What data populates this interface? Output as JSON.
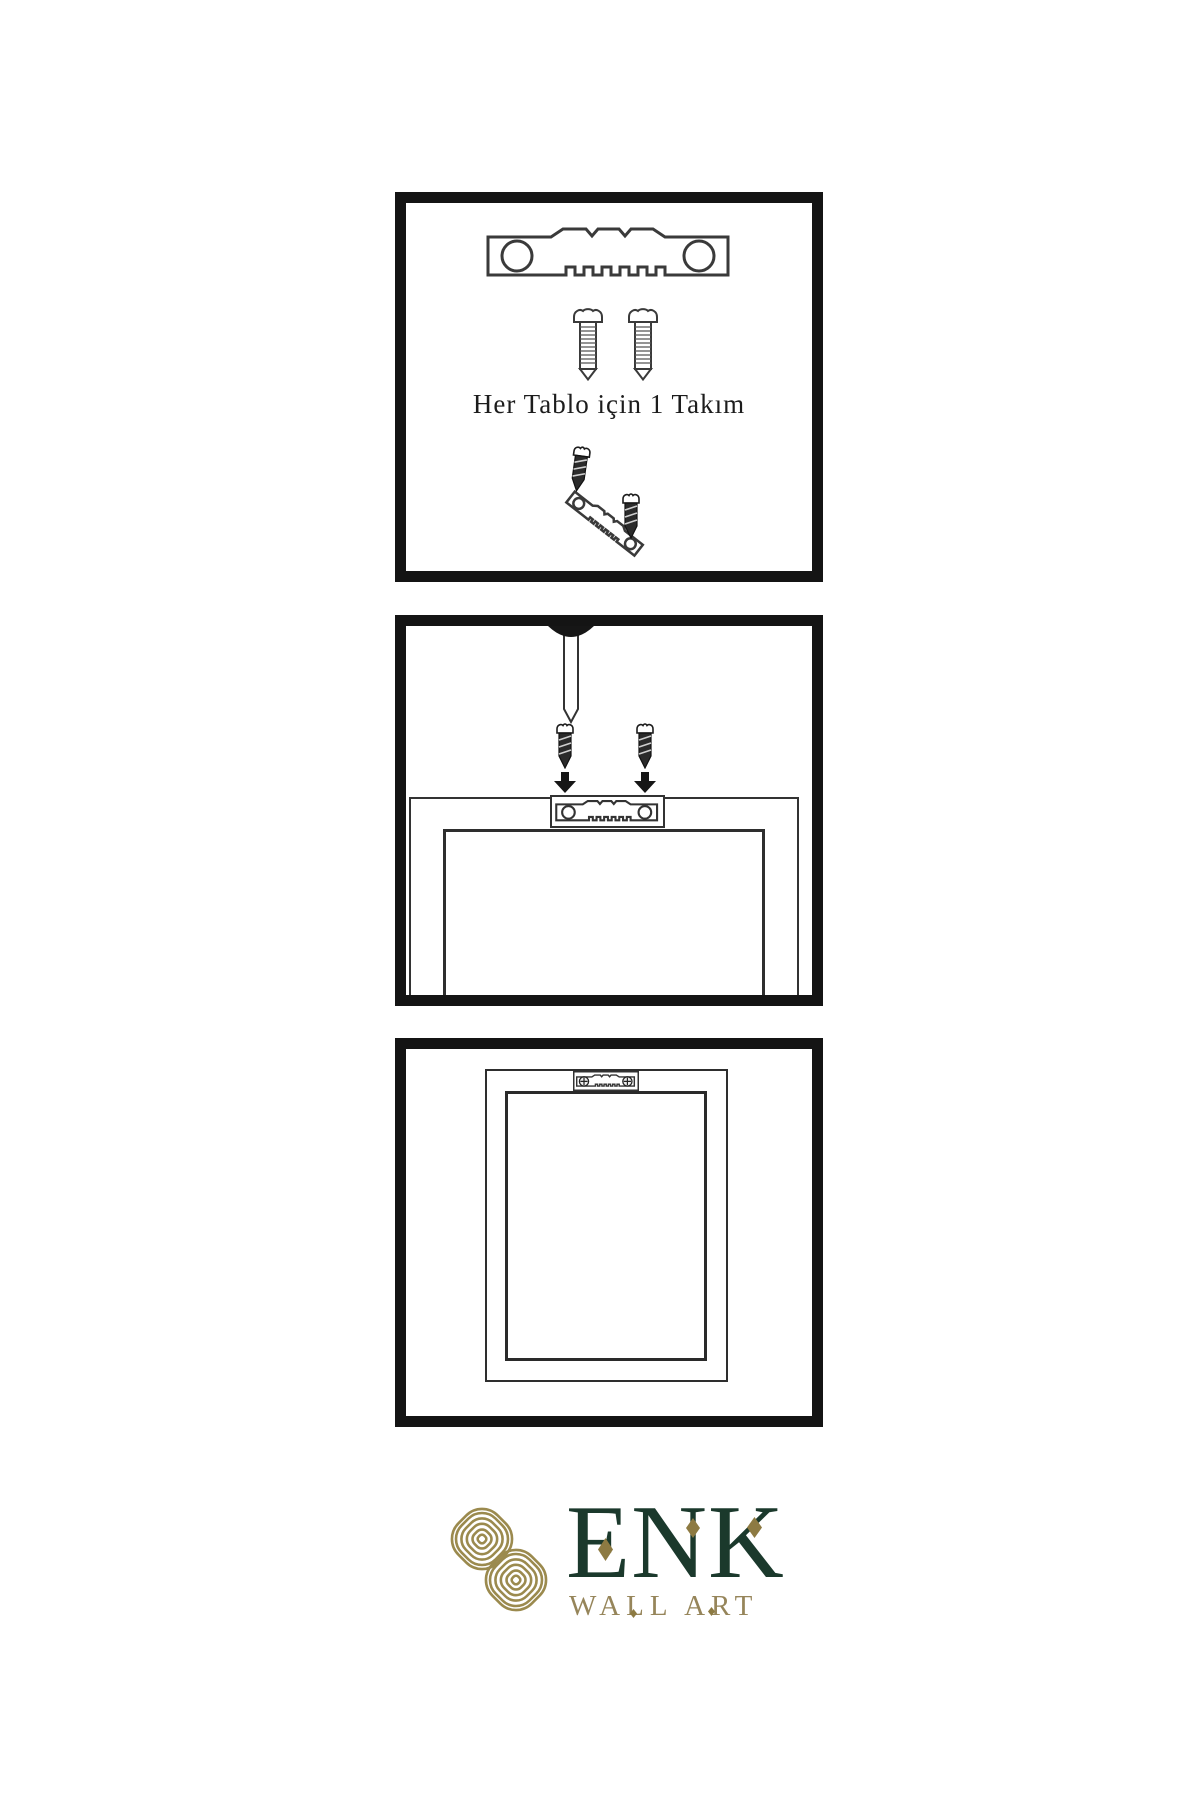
{
  "panels": [
    {
      "id": "hardware-kit",
      "caption": "Her Tablo için 1 Takım"
    },
    {
      "id": "wall-mounting"
    },
    {
      "id": "hung-frame"
    }
  ],
  "logo": {
    "brand": "ENK",
    "subtitle": "WALL ART"
  },
  "colors": {
    "background": "#ffffff",
    "panel_border": "#141414",
    "outline": "#3a3a3a",
    "metal_dark": "#2b2b2b",
    "knot_gold": "#9b8a4e",
    "brand_green": "#1b392c",
    "brand_gold": "#96855a",
    "diamond_gold": "#8d7a42"
  }
}
